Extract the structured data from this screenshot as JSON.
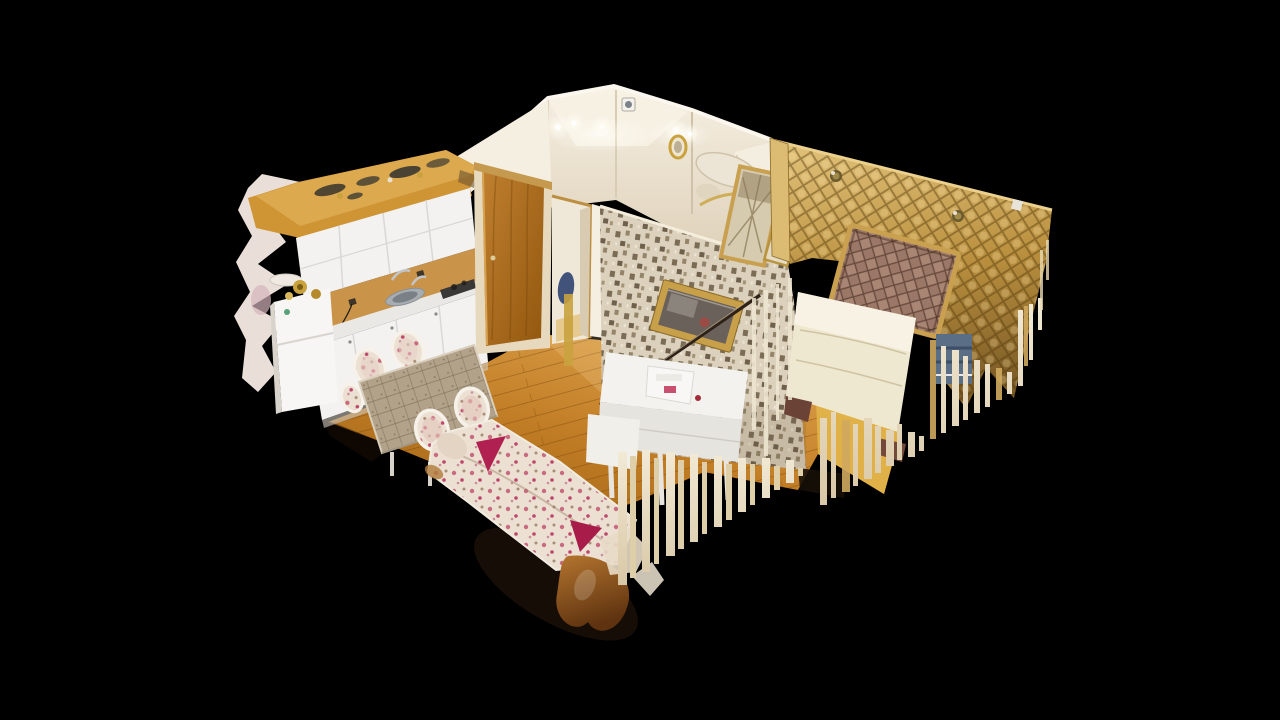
{
  "viewport": {
    "type": "3d-dollhouse-scan-viewer",
    "view_mode": "dollhouse-cutaway",
    "content": "photogrammetry scan of a one-bedroom apartment floating on black"
  },
  "scene": {
    "objects": [
      "kitchen-cabinets",
      "refrigerator",
      "kitchen-sink",
      "cooktop",
      "wood-soffit",
      "entry-door",
      "hallway",
      "ceiling-lights",
      "wall-vent",
      "gold-wall-mirror",
      "mosaic-wallpaper-wall",
      "framed-picture",
      "gold-tufted-wall",
      "tufted-headboard",
      "double-bed",
      "blue-linen-stack",
      "sewing-console",
      "dining-table",
      "dining-chairs",
      "floral-sofa",
      "magenta-cushions",
      "wood-floor",
      "scan-edge-drip-artifacts",
      "torn-mesh-edge"
    ]
  },
  "colors": {
    "background": "#000000",
    "floor_wood_light": "#dfa44e",
    "floor_wood": "#c07c24",
    "floor_wood_dark": "#9a5f14",
    "soffit_wood": "#cf9434",
    "soffit_wood_light": "#dca94f",
    "backsplash_wood": "#c99449",
    "door_wood_light": "#c08030",
    "door_wood_dark": "#92570e",
    "door_frame": "#e7d9bd",
    "cabinet_white": "#f3f2f1",
    "cabinet_line": "#d9d8d6",
    "fridge_white": "#f7f6f4",
    "counter_top": "#eae8e4",
    "sink_steel": "#a8adb1",
    "cooktop_dark": "#3a3836",
    "wall_cream_light": "#f6efe2",
    "wall_cream_dark": "#ddd0b8",
    "wall_white": "#f5efe2",
    "ceiling_bright": "#f7f1e4",
    "mosaic_base": "#dcd1bd",
    "mosaic_dark": "#7b6c56",
    "mosaic_mid": "#93846a",
    "gold_light": "#e3c47c",
    "gold_mid": "#b98f3e",
    "gold_dark": "#7d5c26",
    "gold_trim": "#dcbc72",
    "headboard_brown": "#9b7767",
    "frame_gold": "#c9a050",
    "bed_cream": "#efe8d0",
    "pillow_cream": "#f7f2e3",
    "bed_frame_brown": "#6b4236",
    "floral_base": "#ece0d2",
    "floral_pink": "#c96a80",
    "floral_magenta": "#b02050",
    "floral_leaf": "#a88d77",
    "tablecloth": "#b2a28a",
    "dresser_white": "#f3f2ef",
    "drip_cream_light": "#f2ead6",
    "drip_cream_dark": "#d9c8a6",
    "drip_cream_mid": "#dfcfa9",
    "drip_gold": "#cfa95e",
    "shadow_dark": "#1d1108",
    "blob_tan_light": "#b5762f",
    "blob_tan_dark": "#5f3310",
    "torn_white": "#e9dfd8",
    "torn_pink": "#c9a1a8",
    "blue_item": "#41537a",
    "blue_stack": "#5a6e86",
    "picture_frame": "#c9a04a",
    "picture_canvas": "#6a625a",
    "mirror_gold": "#c9a23e",
    "glow_white": "#ffffff"
  }
}
